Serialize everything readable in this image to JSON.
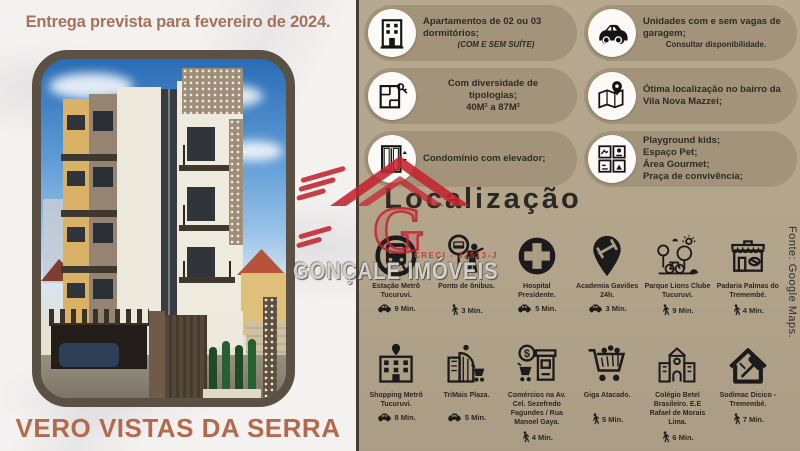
{
  "left_panel": {
    "delivery_banner": "Entrega prevista para fevereiro de 2024.",
    "project_name": "VERO VISTAS DA SERRA"
  },
  "features": [
    {
      "icon": "building-icon",
      "text": "Apartamentos de 02 ou 03 dormitórios;",
      "subtext": "(COM E SEM SUÍTE)"
    },
    {
      "icon": "car-icon",
      "text": "Unidades com e sem vagas de garagem;",
      "subtext": "Consultar disponibilidade."
    },
    {
      "icon": "floorplan-key-icon",
      "text": "Com diversidade de tipologias;",
      "subtext": "40M² a 87M²"
    },
    {
      "icon": "map-pin-icon",
      "text": "Ótima localização no bairro da Vila Nova Mazzei;",
      "subtext": ""
    },
    {
      "icon": "elevator-icon",
      "text": "Condomínio com elevador;",
      "subtext": ""
    },
    {
      "icon": "amenities-grid-icon",
      "lines": [
        "Playground kids;",
        "Espaço Pet;",
        "Área Gourmet;",
        "Praça de convivência;"
      ]
    }
  ],
  "localizacao": {
    "title": "Localização",
    "source_note": "Fonte: Google Maps.",
    "places": [
      {
        "icon": "metro-icon",
        "name": "Estação Metrô Tucuruvi.",
        "mode": "car",
        "time": "9 Min."
      },
      {
        "icon": "bus-stop-icon",
        "name": "Ponto de ônibus.",
        "mode": "walk",
        "time": "3 Min."
      },
      {
        "icon": "hospital-icon",
        "name": "Hospital Presidente.",
        "mode": "car",
        "time": "5 Min."
      },
      {
        "icon": "gym-pin-icon",
        "name": "Academia Gaviões 24h.",
        "mode": "car",
        "time": "3 Min."
      },
      {
        "icon": "park-icon",
        "name": "Parque Lions Clube Tucuruvi.",
        "mode": "walk",
        "time": "9 Min."
      },
      {
        "icon": "bakery-icon",
        "name": "Padaria Palmas do Tremembé.",
        "mode": "walk",
        "time": "4 Min."
      },
      {
        "icon": "mall-icon",
        "name": "Shopping Metrô Tucuruvi.",
        "mode": "car",
        "time": "8 Min."
      },
      {
        "icon": "plaza-icon",
        "name": "TriMais Plaza.",
        "mode": "car",
        "time": "5 Min."
      },
      {
        "icon": "commerce-icon",
        "name": "Comércios na Av. Cel. Sezefredo Fagundes / Rua Manoel Gaya.",
        "mode": "walk",
        "time": "4 Min."
      },
      {
        "icon": "cart-icon",
        "name": "Giga Atacado.",
        "mode": "walk",
        "time": "5 Min."
      },
      {
        "icon": "school-icon",
        "name": "Colégio Betel Brasileiro. E.E Rafael de Morais Lima.",
        "mode": "walk",
        "time": "6 Min."
      },
      {
        "icon": "home-repair-icon",
        "name": "Sodimac Dicico - Tremembé.",
        "mode": "walk",
        "time": "7 Min."
      }
    ]
  },
  "watermark": {
    "agency": "GONÇALE IMÓVEIS",
    "creci": "CRECI - 32513-J",
    "logo_letter": "G"
  },
  "colors": {
    "brand_red": "#c4242e",
    "panel_tan": "#b3a48c",
    "pill_tan": "#a2937a",
    "banner_brown": "#a5735a",
    "title_orange": "#b5694c"
  }
}
